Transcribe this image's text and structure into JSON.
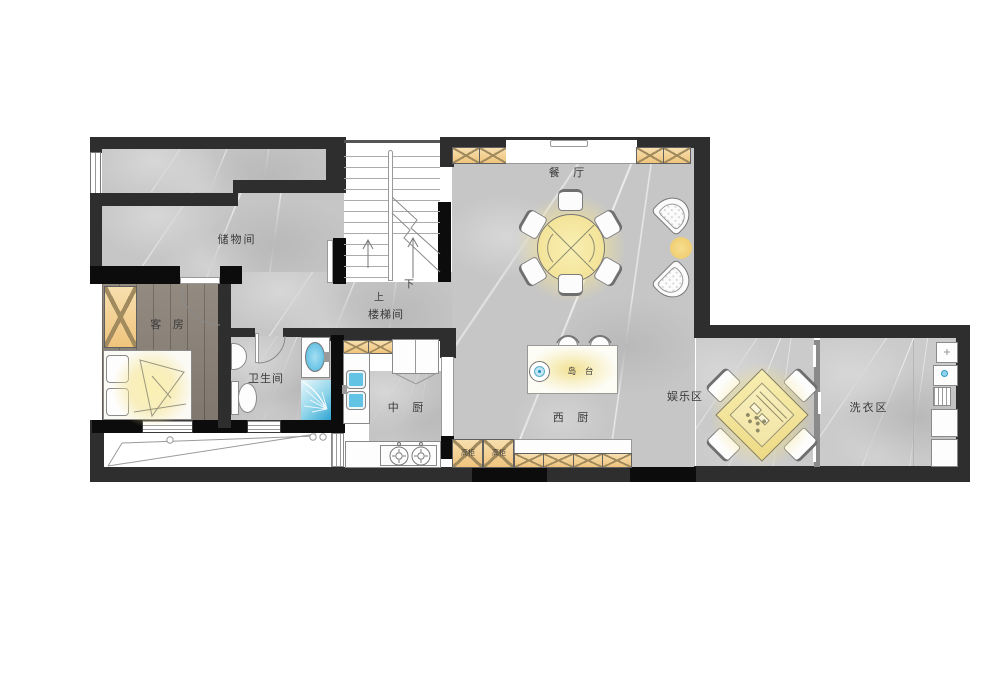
{
  "labels": {
    "storage_room": "储物间",
    "guest_room": "客 房",
    "bathroom": "卫生间",
    "stair_hall": "楼梯间",
    "stairs_up": "上",
    "stairs_down": "下",
    "dining_room": "餐 厅",
    "island_counter": "岛 台",
    "western_kitchen": "西 厨",
    "chinese_kitchen": "中 厨",
    "entertainment_area": "娱乐区",
    "laundry_area": "洗衣区",
    "tall_cabinet_a": "高柜",
    "tall_cabinet_b": "高柜"
  },
  "colors": {
    "wall_dark": "#2e2e2e",
    "wall_black": "#0c0c0c",
    "marble_floor": "#c6c6c6",
    "wood_floor": "#8b8177",
    "cabinet_orange": "#f0c47c",
    "glow_yellow": "#f5e59b",
    "water_blue": "#45b4dc",
    "furniture_white": "#fdfdfd"
  }
}
